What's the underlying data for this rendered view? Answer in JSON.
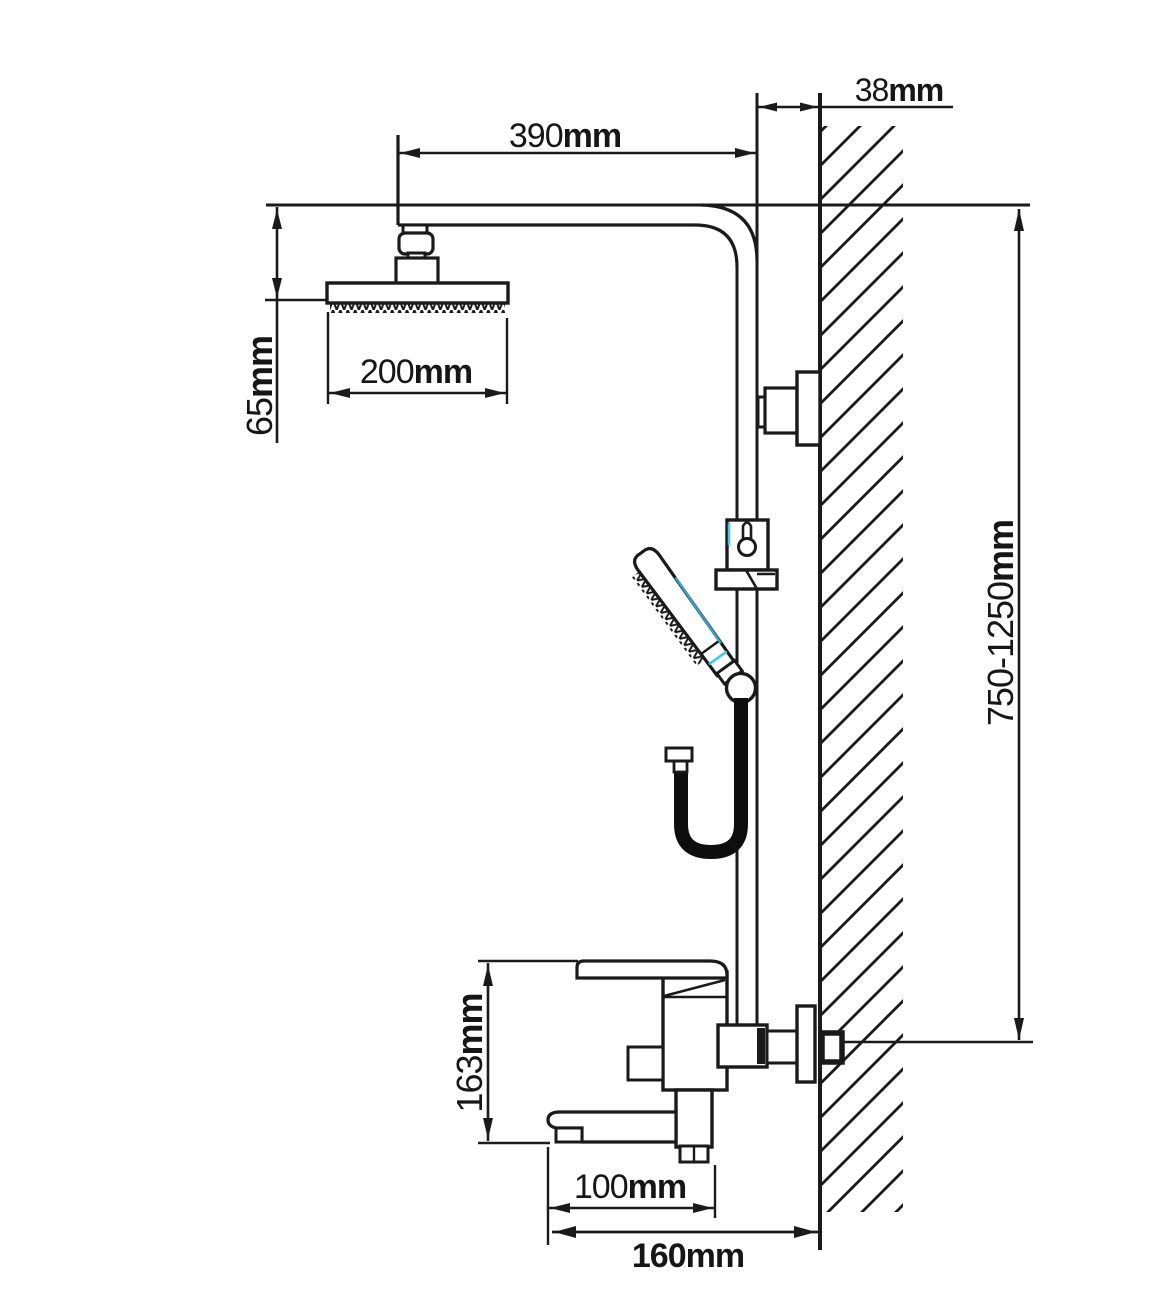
{
  "diagram": {
    "title": "wall-mounted-shower-system-dimension-drawing",
    "colors": {
      "line": "#1a1a1a",
      "background": "#ffffff",
      "accent_cyan": "#3fc6e8"
    },
    "labels": {
      "arm_length": {
        "value": "390",
        "unit": "mm"
      },
      "wall_offset": {
        "value": "38",
        "unit": "mm"
      },
      "head_drop": {
        "value": "65",
        "unit": "mm"
      },
      "head_width": {
        "value": "200",
        "unit": "mm"
      },
      "riser_height": {
        "value": "750-1250",
        "unit": "mm"
      },
      "mixer_height": {
        "value": "163",
        "unit": "mm"
      },
      "spout_reach": {
        "value": "100",
        "unit": "mm"
      },
      "wall_to_spout": {
        "value": "160",
        "unit": "mm"
      }
    }
  }
}
